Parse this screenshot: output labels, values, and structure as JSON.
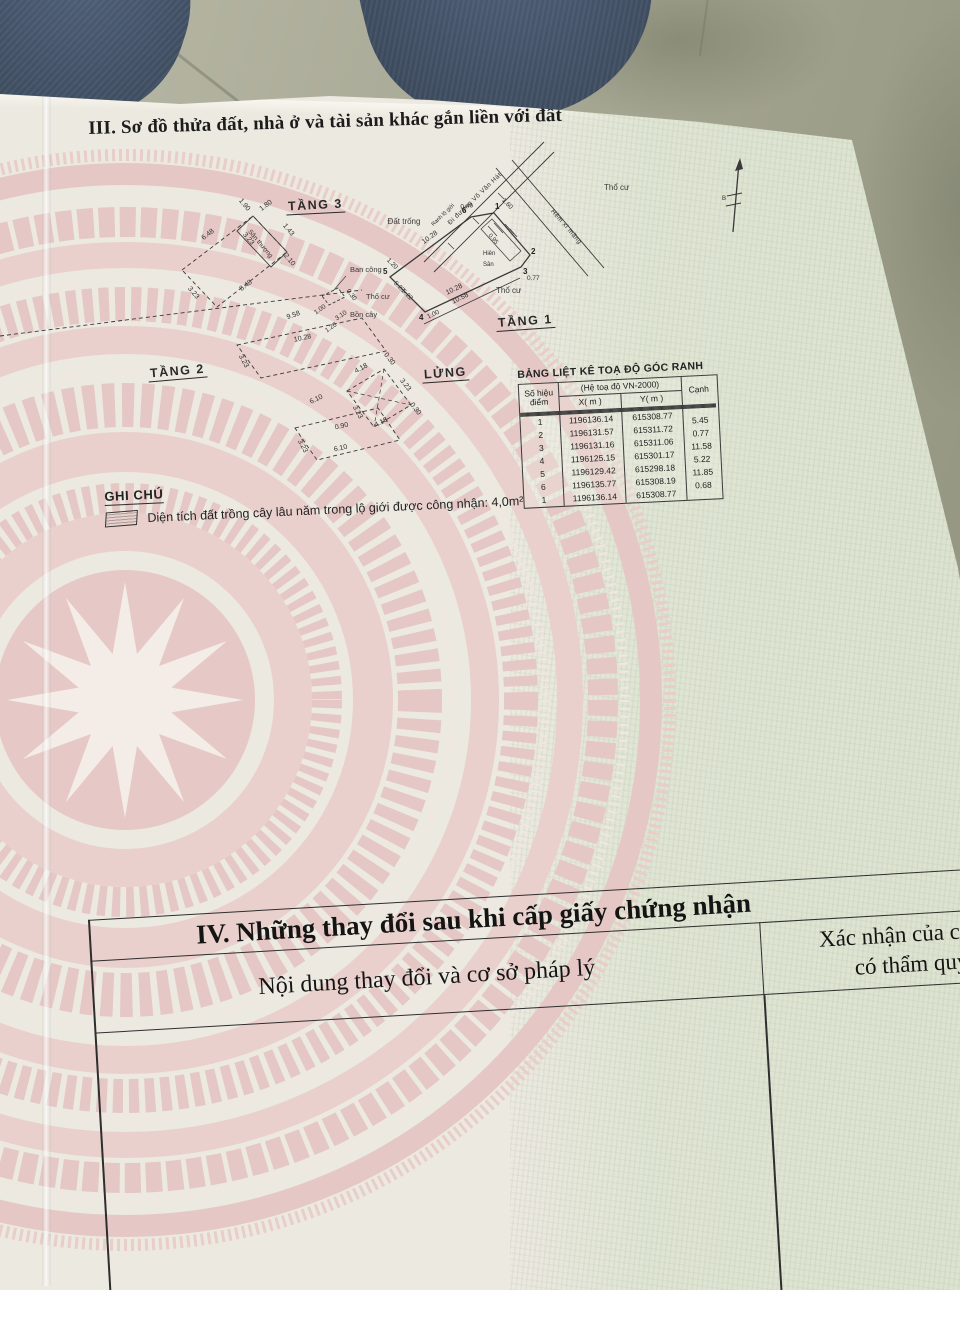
{
  "colors": {
    "paper": "#ece9e1",
    "drum_pink": "#e6c9c6",
    "green_tint": "#dde4d1",
    "line": "#3a3a3a",
    "denim": "#41506a",
    "floor": "#a3a491"
  },
  "document": {
    "section3_title": "III. Sơ đồ thửa đất, nhà ở và tài sản khác gắn liền với đất",
    "note": {
      "label": "GHI CHÚ",
      "text": "Diện tích đất trồng cây lâu năm trong lộ giới được công nhận: 4,0m²"
    },
    "coords": {
      "title": "BẢNG LIỆT KÊ TOẠ ĐỘ GÓC RANH",
      "headers": {
        "point_l1": "Số hiệu",
        "point_l2": "điểm",
        "system": "(Hệ toạ độ VN-2000)",
        "x": "X( m )",
        "y": "Y( m )",
        "edge": "Cạnh"
      },
      "rows": [
        {
          "p": "1",
          "x": "1196136.14",
          "y": "615308.77",
          "c": ""
        },
        {
          "p": "2",
          "x": "1196131.57",
          "y": "615311.72",
          "c": "5.45"
        },
        {
          "p": "3",
          "x": "1196131.16",
          "y": "615311.06",
          "c": "0.77"
        },
        {
          "p": "4",
          "x": "1196125.15",
          "y": "615301.17",
          "c": "11.58"
        },
        {
          "p": "5",
          "x": "1196129.42",
          "y": "615298.18",
          "c": "5.22"
        },
        {
          "p": "6",
          "x": "1196135.77",
          "y": "615308.19",
          "c": "11.85"
        },
        {
          "p": "1",
          "x": "1196136.14",
          "y": "615308.77",
          "c": "0.68"
        }
      ]
    },
    "plans": {
      "t3": {
        "title": "TẦNG 3",
        "room": "Sân thượng",
        "balcony": "Ban công",
        "dims": [
          "6.48",
          "1.90",
          "1.80",
          "1.43",
          "3.23",
          "2.10",
          "8.48",
          "3.23",
          "9.58"
        ],
        "bdims": [
          "1.00",
          "0.30",
          "3.10",
          "1.20"
        ]
      },
      "t2": {
        "title": "TẦNG 2",
        "dims": [
          "10.28",
          "3.23",
          "6.10",
          "3.23",
          "6.10"
        ]
      },
      "lung": {
        "title": "LỬNG",
        "dims": [
          "4.18",
          "0.30",
          "3.23",
          "0.30",
          "3.23",
          "4.18",
          "0.90"
        ]
      },
      "t1": {
        "title": "TẦNG 1",
        "road": "Đi đường Võ Văn Hát",
        "road_edge": "Ranh lộ giới",
        "alley": "Hẻm xi măng",
        "area_top": "Thổ cư",
        "area_left": "Đất trống",
        "area_bottom": "Thổ cư",
        "area_west": "Thổ cư",
        "garden": "Bồn cây",
        "porch": "Hiên",
        "yard": "Sân",
        "north": "B",
        "corners": [
          "1",
          "2",
          "3",
          "4",
          "5",
          "6"
        ],
        "dims": [
          "0.46",
          "1.60",
          "10.28",
          "10.28",
          "10.58",
          "0.77",
          "5.23",
          "5.22",
          "1.00",
          "1.20",
          "0.95"
        ]
      }
    },
    "section4": {
      "title": "IV. Những thay đổi sau khi cấp giấy chứng nhận",
      "col1": "Nội dung thay đổi và cơ sở pháp lý",
      "col2_line1": "Xác nhận của cơ quan",
      "col2_line2": "có thẩm quyền"
    }
  }
}
